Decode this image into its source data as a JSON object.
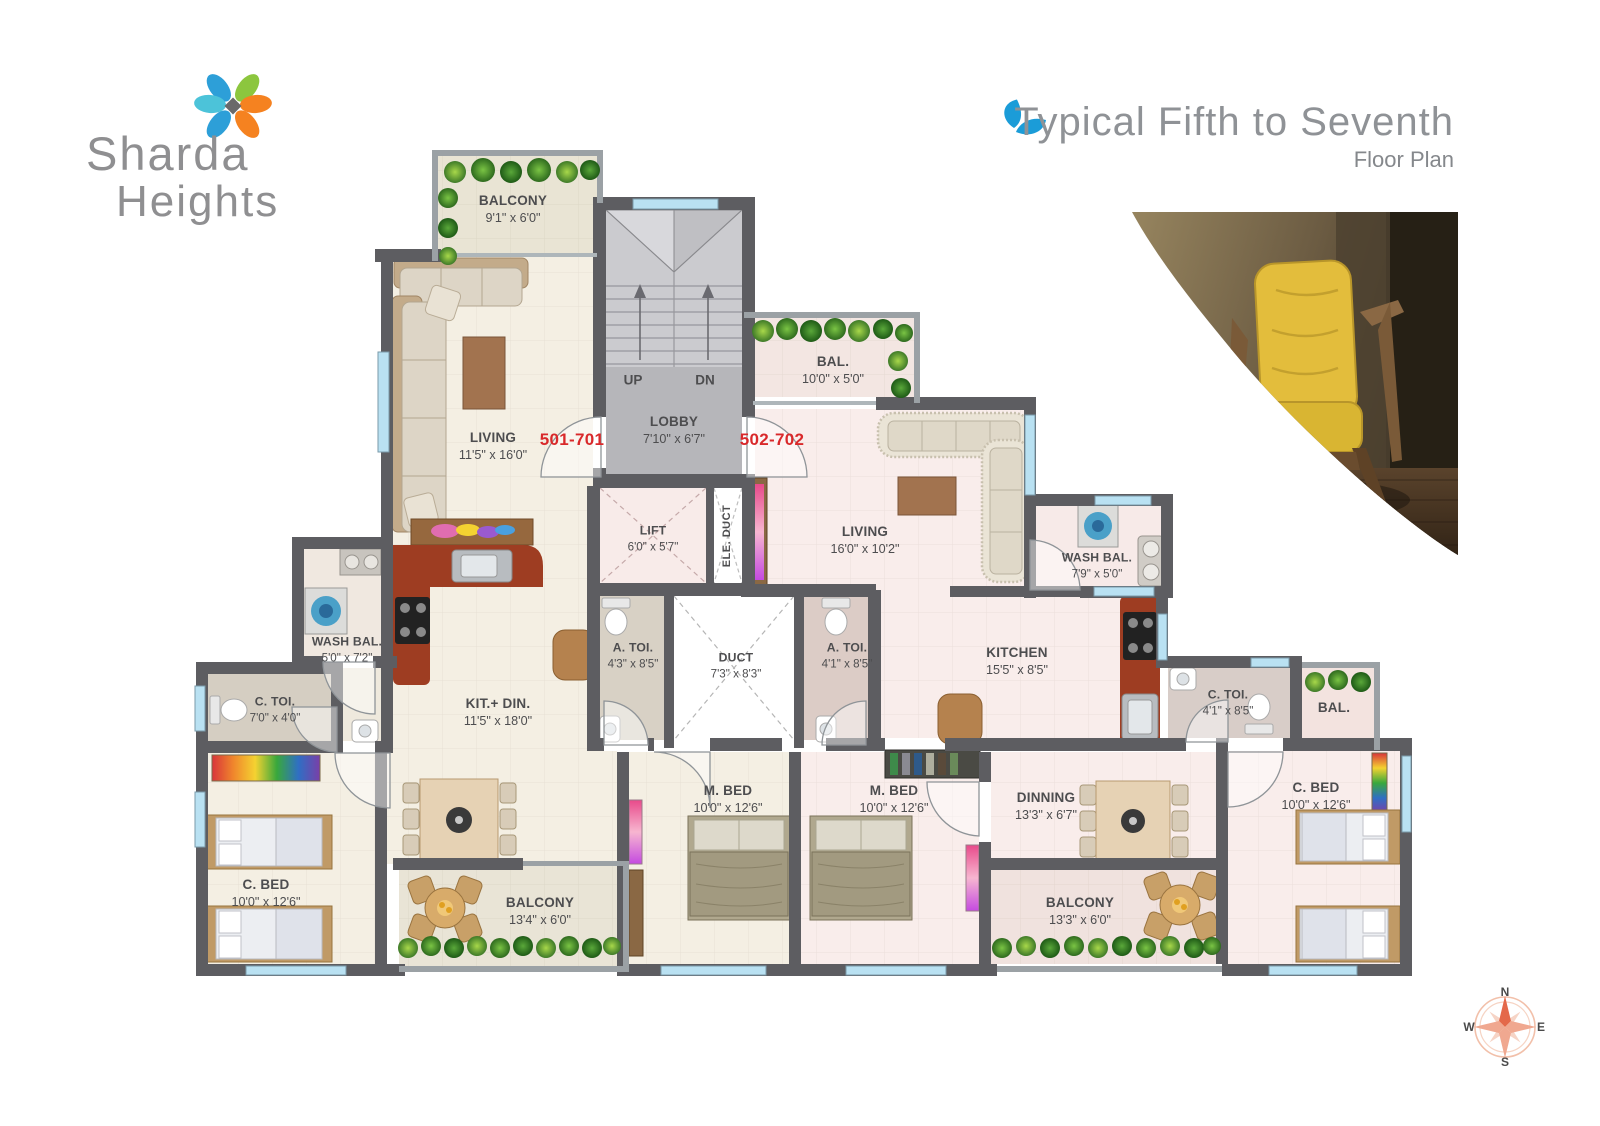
{
  "brand": {
    "line1": "Sharda",
    "line2": "Heights"
  },
  "title": {
    "main": "Typical Fifth to Seventh",
    "sub": "Floor Plan"
  },
  "unit_labels": {
    "left": "501-701",
    "right": "502-702"
  },
  "stairs": {
    "up": "UP",
    "dn": "DN"
  },
  "compass": {
    "n": "N",
    "e": "E",
    "s": "S",
    "w": "W"
  },
  "rooms": {
    "balcony_501_top": {
      "name": "BALCONY",
      "dims": "9'1\" x 6'0\""
    },
    "living_501": {
      "name": "LIVING",
      "dims": "11'5\" x 16'0\""
    },
    "lobby": {
      "name": "LOBBY",
      "dims": "7'10\" x 6'7\""
    },
    "bal_502_top": {
      "name": "BAL.",
      "dims": "10'0\" x 5'0\""
    },
    "living_502": {
      "name": "LIVING",
      "dims": "16'0\" x 10'2\""
    },
    "wash_bal_502": {
      "name": "WASH BAL.",
      "dims": "7'9\" x 5'0\""
    },
    "lift": {
      "name": "LIFT",
      "dims": "6'0\" x 5'7\""
    },
    "ele_duct": {
      "name": "ELE. DUCT"
    },
    "wash_bal_501": {
      "name": "WASH BAL.",
      "dims": "5'0\" x 7'2\""
    },
    "c_toi_501": {
      "name": "C. TOI.",
      "dims": "7'0\" x 4'0\""
    },
    "kit_din_501": {
      "name": "KIT.+ DIN.",
      "dims": "11'5\" x 18'0\""
    },
    "a_toi_501": {
      "name": "A. TOI.",
      "dims": "4'3\" x 8'5\""
    },
    "duct": {
      "name": "DUCT",
      "dims": "7'3\" x 8'3\""
    },
    "a_toi_502": {
      "name": "A. TOI.",
      "dims": "4'1\" x 8'5\""
    },
    "kitchen_502": {
      "name": "KITCHEN",
      "dims": "15'5\" x 8'5\""
    },
    "c_toi_502": {
      "name": "C. TOI.",
      "dims": "4'1\" x 8'5\""
    },
    "bal_502_right": {
      "name": "BAL."
    },
    "c_bed_501": {
      "name": "C. BED",
      "dims": "10'0\" x 12'6\""
    },
    "m_bed_501": {
      "name": "M. BED",
      "dims": "10'0\" x 12'6\""
    },
    "m_bed_502": {
      "name": "M. BED",
      "dims": "10'0\" x 12'6\""
    },
    "dinning_502": {
      "name": "DINNING",
      "dims": "13'3\" x 6'7\""
    },
    "c_bed_502": {
      "name": "C. BED",
      "dims": "10'0\" x 12'6\""
    },
    "balcony_501_bottom": {
      "name": "BALCONY",
      "dims": "13'4\" x 6'0\""
    },
    "balcony_502_bottom": {
      "name": "BALCONY",
      "dims": "13'3\" x 6'0\""
    }
  },
  "colors": {
    "wall": "#5d5d61",
    "accent_red": "#d9292b",
    "window": "#b9e1f2",
    "floor_cream": "#f4efe3",
    "floor_pink": "#f9edeb",
    "counter_red": "#9e3d22",
    "logo_blue": "#2d9fd8",
    "logo_green": "#8cc63e",
    "logo_orange": "#f58220",
    "logo_cyan": "#4cc3d9"
  }
}
